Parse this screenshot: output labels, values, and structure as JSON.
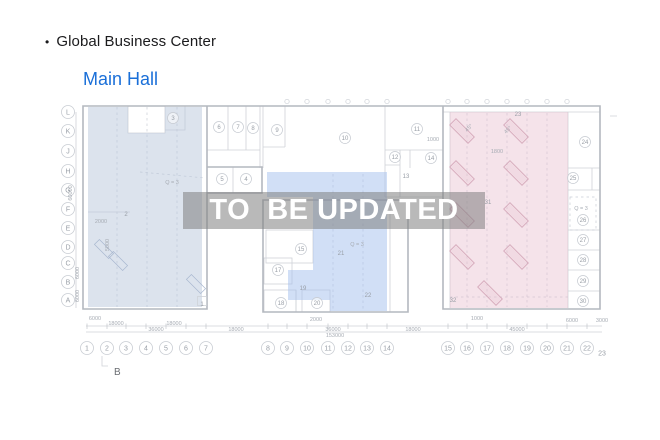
{
  "header": {
    "bullet": "•",
    "title": "Global Business Center",
    "subtitle": "Main Hall"
  },
  "watermark": {
    "text": "TO  BE UPDATED"
  },
  "colors": {
    "accent_blue": "#1a6fd8",
    "title_text": "#1b1b1d",
    "region_left": "#b9c7dc",
    "region_middle": "#a3c0ee",
    "region_right": "#e6bccd",
    "watermark_band": "rgba(128,128,128,0.55)",
    "watermark_text": "#ffffff"
  },
  "plan": {
    "rows": [
      {
        "label": "L",
        "y": 112
      },
      {
        "label": "K",
        "y": 131
      },
      {
        "label": "J",
        "y": 151
      },
      {
        "label": "H",
        "y": 171
      },
      {
        "label": "G",
        "y": 190
      },
      {
        "label": "F",
        "y": 209
      },
      {
        "label": "E",
        "y": 228
      },
      {
        "label": "D",
        "y": 247
      },
      {
        "label": "C",
        "y": 263
      },
      {
        "label": "B",
        "y": 282
      },
      {
        "label": "A",
        "y": 300
      }
    ],
    "cols": [
      {
        "label": "1",
        "x": 87
      },
      {
        "label": "2",
        "x": 107
      },
      {
        "label": "3",
        "x": 126
      },
      {
        "label": "4",
        "x": 146
      },
      {
        "label": "5",
        "x": 166
      },
      {
        "label": "6",
        "x": 186
      },
      {
        "label": "7",
        "x": 206
      },
      {
        "label": "8",
        "x": 268
      },
      {
        "label": "9",
        "x": 287
      },
      {
        "label": "10",
        "x": 307
      },
      {
        "label": "11",
        "x": 328
      },
      {
        "label": "12",
        "x": 348
      },
      {
        "label": "13",
        "x": 367
      },
      {
        "label": "14",
        "x": 387
      },
      {
        "label": "15",
        "x": 448
      },
      {
        "label": "16",
        "x": 467
      },
      {
        "label": "17",
        "x": 487
      },
      {
        "label": "18",
        "x": 507
      },
      {
        "label": "19",
        "x": 527
      },
      {
        "label": "20",
        "x": 547
      },
      {
        "label": "21",
        "x": 567
      },
      {
        "label": "22",
        "x": 587
      },
      {
        "label": "23",
        "x": 602,
        "y": 353,
        "circle": false
      }
    ],
    "rooms_circled": [
      {
        "n": "3",
        "x": 173,
        "y": 118
      },
      {
        "n": "6",
        "x": 219,
        "y": 127
      },
      {
        "n": "7",
        "x": 238,
        "y": 127
      },
      {
        "n": "8",
        "x": 253,
        "y": 128
      },
      {
        "n": "9",
        "x": 277,
        "y": 130
      },
      {
        "n": "10",
        "x": 345,
        "y": 138
      },
      {
        "n": "11",
        "x": 417,
        "y": 129
      },
      {
        "n": "12",
        "x": 395,
        "y": 157
      },
      {
        "n": "14",
        "x": 431,
        "y": 158
      },
      {
        "n": "5",
        "x": 222,
        "y": 179
      },
      {
        "n": "4",
        "x": 246,
        "y": 179
      },
      {
        "n": "15",
        "x": 301,
        "y": 249
      },
      {
        "n": "17",
        "x": 278,
        "y": 270
      },
      {
        "n": "18",
        "x": 281,
        "y": 303
      },
      {
        "n": "20",
        "x": 317,
        "y": 303
      },
      {
        "n": "24",
        "x": 585,
        "y": 142
      },
      {
        "n": "25",
        "x": 573,
        "y": 178
      },
      {
        "n": "26",
        "x": 583,
        "y": 220
      },
      {
        "n": "27",
        "x": 583,
        "y": 240
      },
      {
        "n": "28",
        "x": 583,
        "y": 260
      },
      {
        "n": "29",
        "x": 583,
        "y": 281
      },
      {
        "n": "30",
        "x": 583,
        "y": 301
      }
    ],
    "rooms_plain": [
      {
        "n": "2",
        "x": 126,
        "y": 214
      },
      {
        "n": "13",
        "x": 406,
        "y": 176
      },
      {
        "n": "19",
        "x": 303,
        "y": 288
      },
      {
        "n": "21",
        "x": 341,
        "y": 253
      },
      {
        "n": "22",
        "x": 368,
        "y": 295
      },
      {
        "n": "31",
        "x": 488,
        "y": 202
      },
      {
        "n": "32",
        "x": 453,
        "y": 300
      },
      {
        "n": "23",
        "x": 518,
        "y": 114
      },
      {
        "n": "1",
        "x": 202,
        "y": 304,
        "box": true
      }
    ],
    "annotations": [
      {
        "t": "Q = 3",
        "x": 172,
        "y": 184
      },
      {
        "t": "Q = 3",
        "x": 357,
        "y": 246
      },
      {
        "t": "Q = 3",
        "x": 581,
        "y": 210
      },
      {
        "t": "1800",
        "x": 497,
        "y": 153
      },
      {
        "t": "1000",
        "x": 433,
        "y": 141
      },
      {
        "t": "2000",
        "x": 101,
        "y": 223
      },
      {
        "t": "45°",
        "x": 470,
        "y": 129,
        "r": -45
      },
      {
        "t": "45°",
        "x": 509,
        "y": 131,
        "r": -45
      },
      {
        "t": "5000",
        "x": 109,
        "y": 245,
        "r": -90
      }
    ],
    "dims_bottom": [
      {
        "t": "6000",
        "x": 95,
        "y": 320
      },
      {
        "t": "2000",
        "x": 316,
        "y": 321
      },
      {
        "t": "1000",
        "x": 477,
        "y": 320
      },
      {
        "t": "6000",
        "x": 572,
        "y": 322
      },
      {
        "t": "3000",
        "x": 602,
        "y": 322
      },
      {
        "t": "18000",
        "x": 116,
        "y": 325
      },
      {
        "t": "18000",
        "x": 174,
        "y": 325
      },
      {
        "t": "36000",
        "x": 156,
        "y": 331
      },
      {
        "t": "18000",
        "x": 236,
        "y": 331
      },
      {
        "t": "36000",
        "x": 333,
        "y": 331
      },
      {
        "t": "18000",
        "x": 413,
        "y": 331
      },
      {
        "t": "45000",
        "x": 517,
        "y": 331
      },
      {
        "t": "153000",
        "x": 335,
        "y": 337
      }
    ],
    "dims_left": [
      {
        "t": "60000",
        "x": 72,
        "y": 193,
        "r": -90
      },
      {
        "t": "6000",
        "x": 79,
        "y": 273,
        "r": -90
      },
      {
        "t": "6000",
        "x": 79,
        "y": 296,
        "r": -90
      }
    ],
    "marker_b": {
      "t": "B",
      "x": 114,
      "y": 375
    }
  }
}
